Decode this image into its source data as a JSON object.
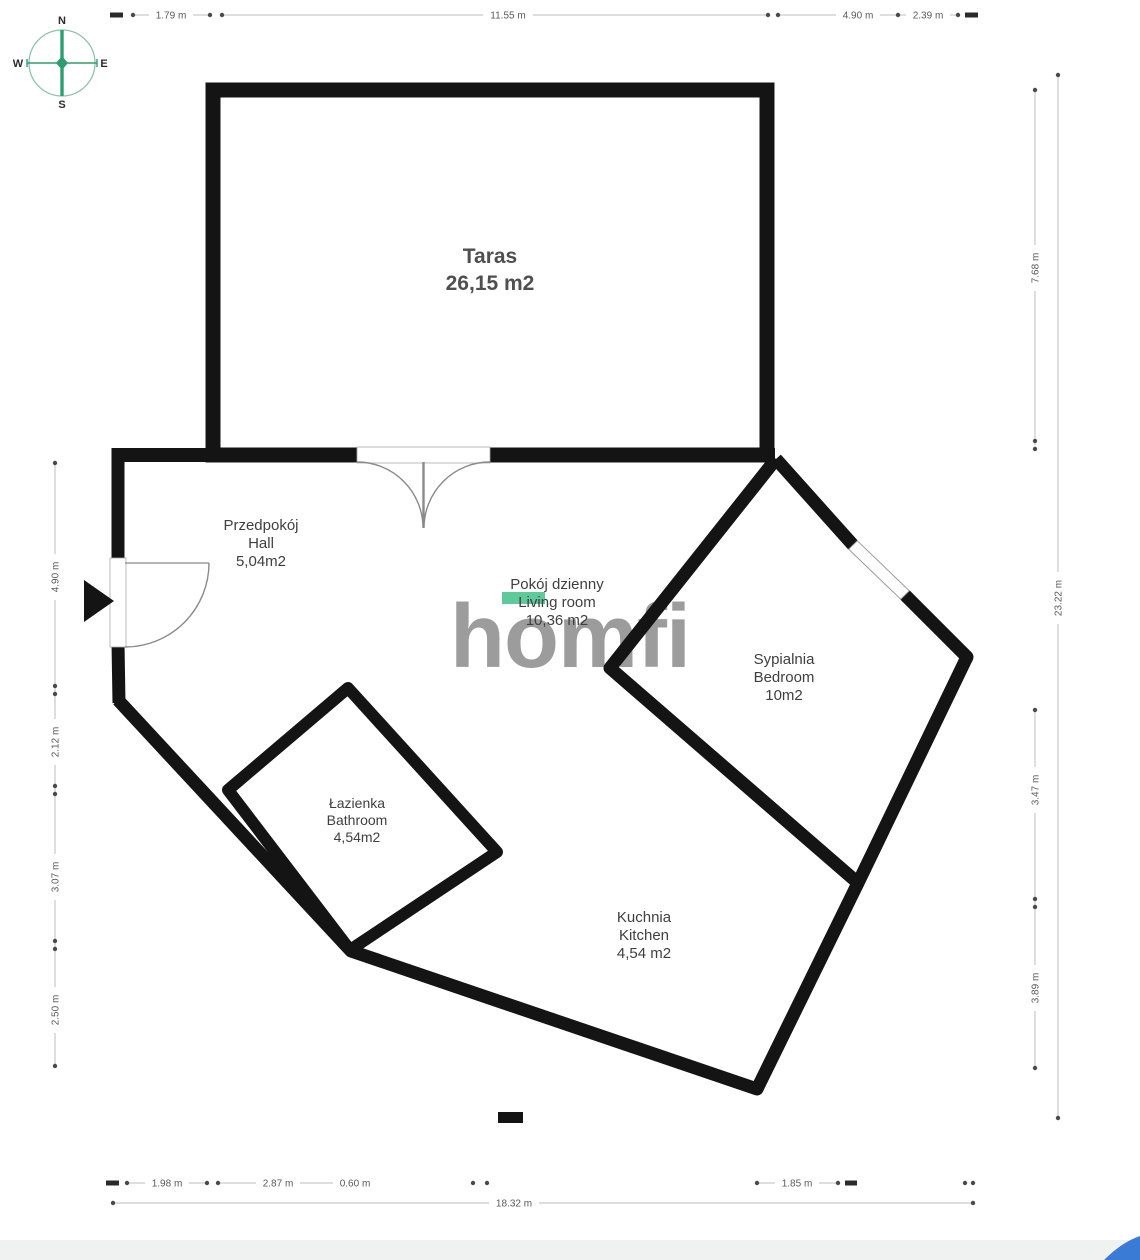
{
  "watermark": "homfi",
  "compass": {
    "north": "N",
    "south": "S",
    "east": "E",
    "west": "W"
  },
  "rooms": {
    "terrace": {
      "name_pl": "Taras",
      "area": "26,15 m2"
    },
    "hall": {
      "name_pl": "Przedpokój",
      "name_en": "Hall",
      "area": "5,04m2"
    },
    "living": {
      "name_pl": "Pokój dzienny",
      "name_en": "Living room",
      "area": "10,36 m2"
    },
    "bedroom": {
      "name_pl": "Sypialnia",
      "name_en": "Bedroom",
      "area": "10m2"
    },
    "bathroom": {
      "name_pl": "Łazienka",
      "name_en": "Bathroom",
      "area": "4,54m2"
    },
    "kitchen": {
      "name_pl": "Kuchnia",
      "name_en": "Kitchen",
      "area": "4,54 m2"
    }
  },
  "dimensions": {
    "top": [
      "1.79 m",
      "11.55 m",
      "4.90 m",
      "2.39 m"
    ],
    "left": [
      "4.90 m",
      "2.12 m",
      "3.07 m",
      "2.50 m"
    ],
    "right": [
      "7.68 m",
      "3.47 m",
      "3.89 m"
    ],
    "right_total": "23.22 m",
    "bottom": [
      "1.98 m",
      "2.87 m",
      "0.60 m",
      "1.85 m"
    ],
    "bottom_total": "18.32 m"
  },
  "colors": {
    "wall": "#141414",
    "highlight_green": "#5ec99b",
    "compass_green": "#2f9e6e",
    "watermark_gray": "#9c9c9c",
    "dimension_line": "#bcbcbc",
    "dimension_text": "#5a5a5a",
    "footer_blue": "#3a7bd5"
  }
}
